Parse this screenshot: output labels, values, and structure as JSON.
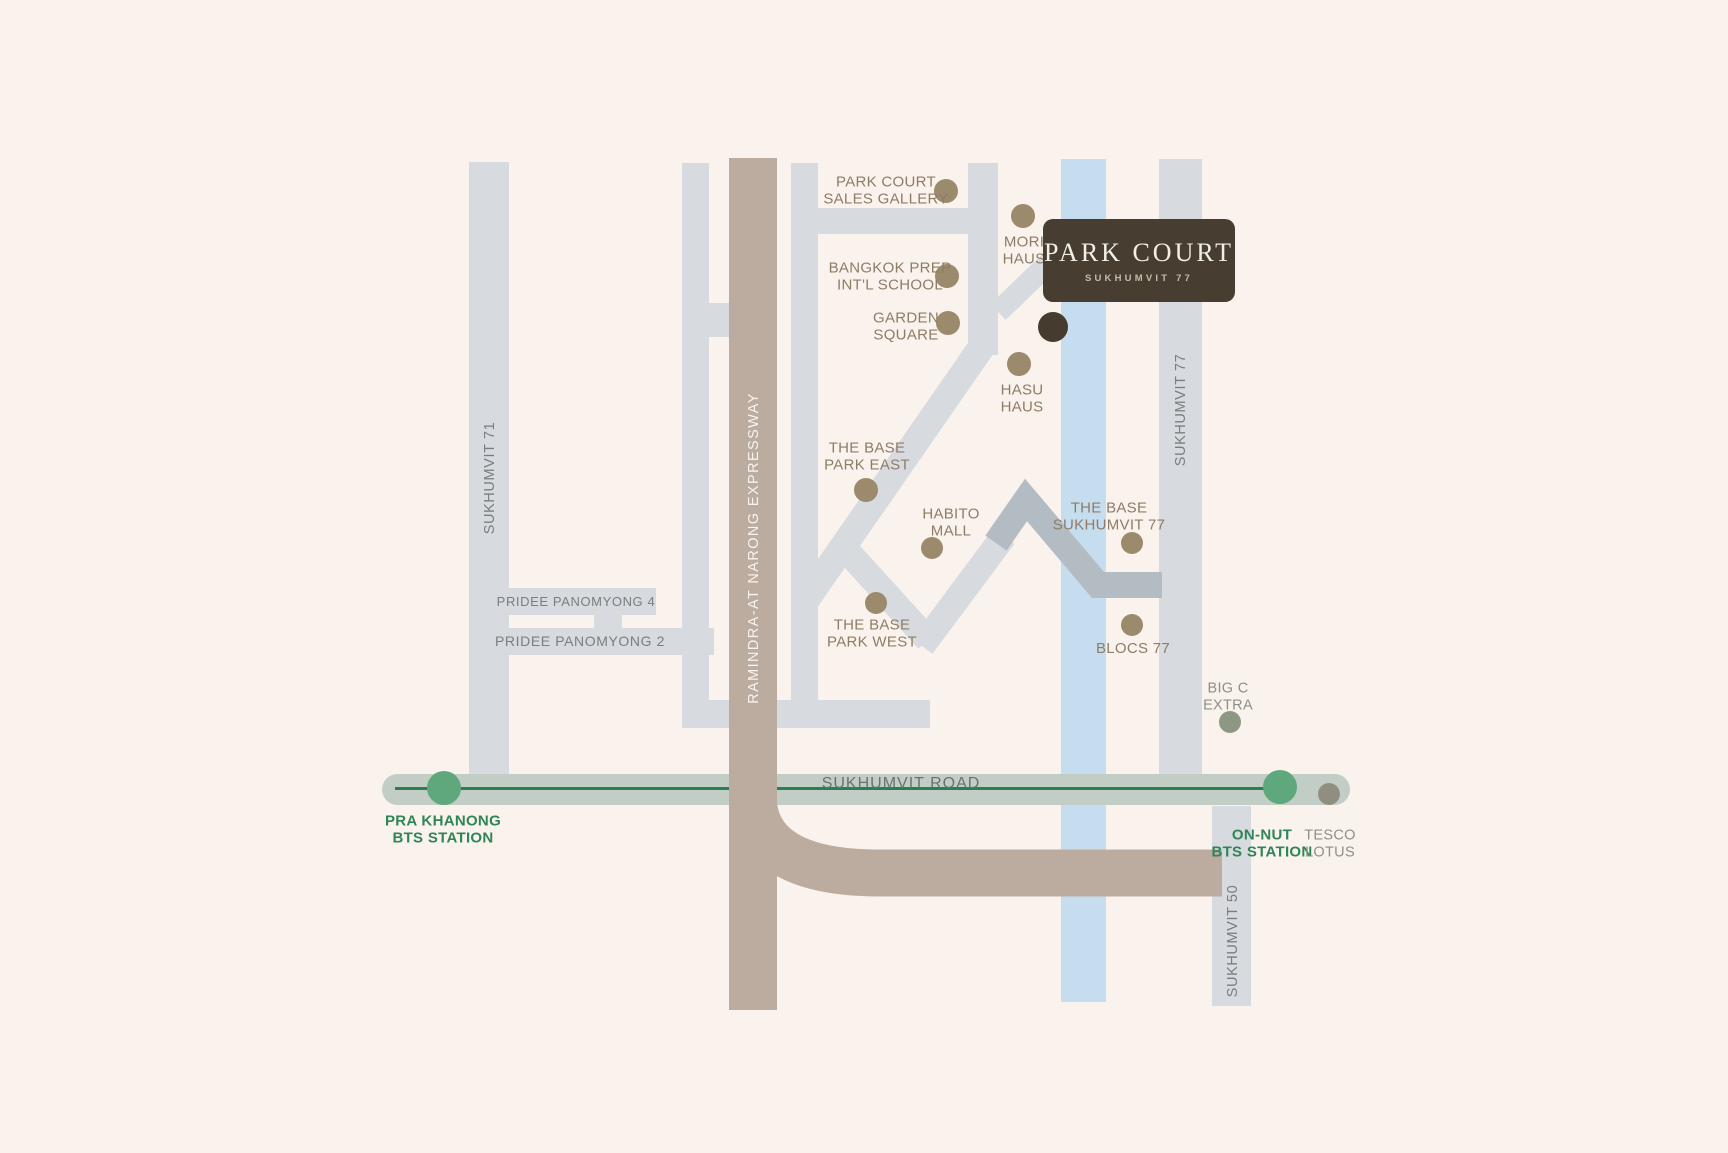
{
  "brand": {
    "title": "PARK COURT",
    "subtitle": "SUKHUMVIT 77"
  },
  "road_labels": {
    "sukhumvit_71": "SUKHUMVIT 71",
    "pridee_panomyong_4": "PRIDEE PANOMYONG 4",
    "pridee_panomyong_2": "PRIDEE PANOMYONG 2",
    "expressway": "RAMINDRA-AT NARONG EXPRESSWAY",
    "sukhumvit_77": "SUKHUMVIT 77",
    "sukhumvit_road": "SUKHUMVIT ROAD",
    "sukhumvit_50": "SUKHUMVIT 50"
  },
  "pois": [
    {
      "id": "park-court-sales-gallery",
      "label": "PARK COURT\nSALES GALLERY"
    },
    {
      "id": "mori-haus",
      "label": "MORI\nHAUS"
    },
    {
      "id": "bangkok-prep",
      "label": "BANGKOK PREP\nINT'L SCHOOL"
    },
    {
      "id": "garden-square",
      "label": "GARDEN\nSQUARE"
    },
    {
      "id": "hasu-haus",
      "label": "HASU\nHAUS"
    },
    {
      "id": "the-base-park-east",
      "label": "THE BASE\nPARK EAST"
    },
    {
      "id": "habito-mall",
      "label": "HABITO\nMALL"
    },
    {
      "id": "the-base-sukhumvit-77",
      "label": "THE BASE\nSUKHUMVIT 77"
    },
    {
      "id": "the-base-park-west",
      "label": "THE BASE\nPARK WEST"
    },
    {
      "id": "blocs-77",
      "label": "BLOCS 77"
    },
    {
      "id": "big-c-extra",
      "label": "BIG C\nEXTRA"
    }
  ],
  "stations": [
    {
      "id": "pra-khanong",
      "label": "PRA KHANONG\nBTS STATION"
    },
    {
      "id": "on-nut",
      "label": "ON-NUT\nBTS STATION"
    }
  ],
  "retail": {
    "tesco_lotus": "TESCO\nLOTUS"
  },
  "colors": {
    "background": "#faf2ec",
    "road_light": "#d7dade",
    "road_dark": "#b4bcc3",
    "expressway_tan": "#bcaca0",
    "canal_blue": "#c6dcef",
    "sukhumvit_band": "#c2cec5",
    "bts_line_green": "#2d7c52",
    "bts_dot_green": "#5fa77c",
    "station_text_green": "#2e8557",
    "poi_dot": "#9b8a6c",
    "project_dot": "#453b2e",
    "logo_bg": "#473e31",
    "poi_text": "#8d7d66",
    "road_text": "#7b7d80",
    "big_c_dot": "#8d9884",
    "tesco_dot": "#908e81"
  }
}
